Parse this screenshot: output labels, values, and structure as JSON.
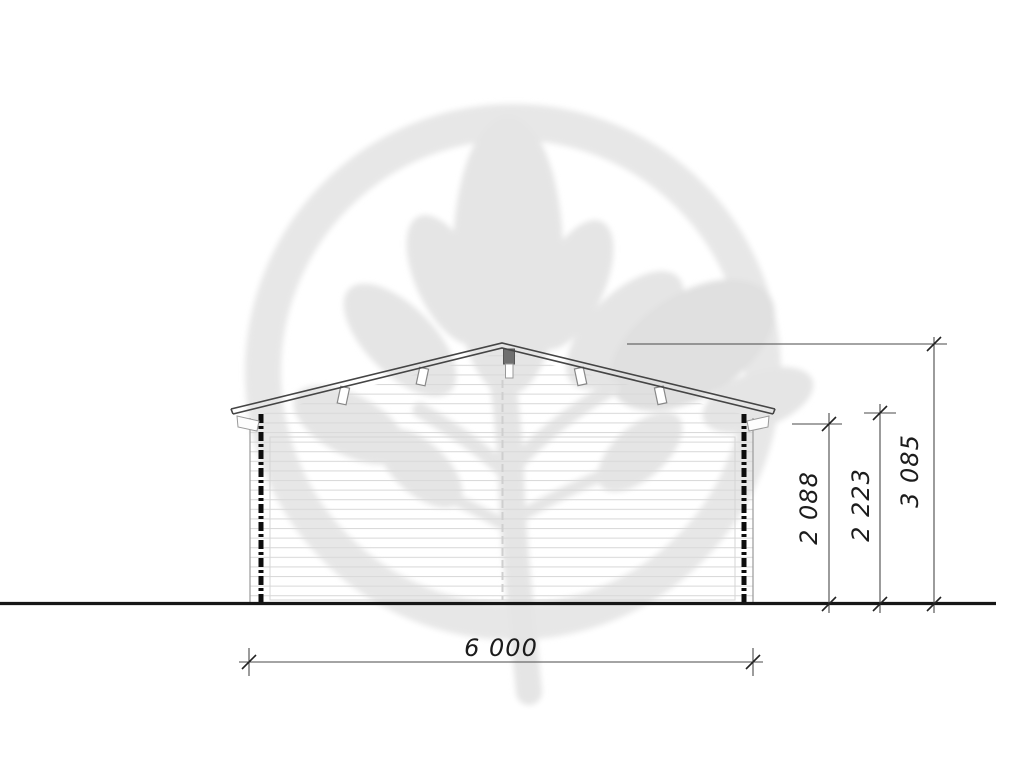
{
  "drawing": {
    "type": "front-elevation",
    "subject": "gable-roof log cabin elevation",
    "dimensions": {
      "width_label": "6 000",
      "eaves_height_label": "2 088",
      "wall_top_height_label": "2 223",
      "ridge_height_label": "3 085"
    },
    "colors": {
      "dimension_line": "#4a4a4a",
      "roof_line": "#454545",
      "ground_line": "#161616",
      "siding_line": "#d9d9d9",
      "corner_post": "#0d0d0d",
      "watermark": "#e6e6e6",
      "text": "#1c1c1c"
    },
    "icons": {
      "watermark": "leaf-tree-circle-logo"
    }
  }
}
